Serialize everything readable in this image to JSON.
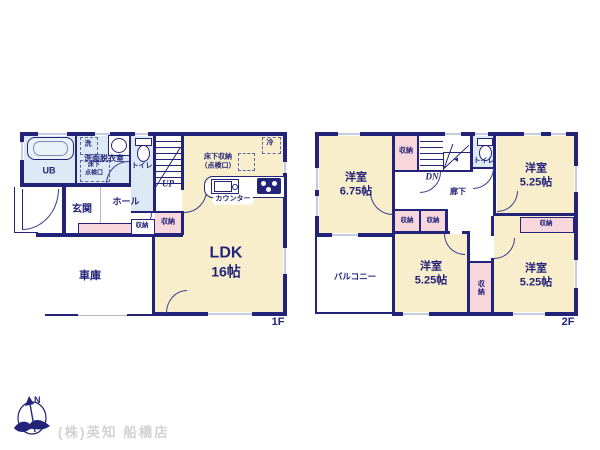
{
  "colors": {
    "wall_navy": "#23237a",
    "room_cream": "#f8eecb",
    "closet_pink": "#f8d7dc",
    "wet_area_blue": "#dde9f4",
    "company_gray": "#d3d3d3"
  },
  "floor1": {
    "label": "1F",
    "ub": "UB",
    "washer": "洗",
    "washroom": "洗面脱衣室",
    "inspect1": "床下",
    "inspect2": "点検口",
    "toilet": "トイレ",
    "up": "UP",
    "underfloor1": "床下収納",
    "underfloor2": "（点検口）",
    "fridge": "冷",
    "counter": "カウンター",
    "entrance": "玄関",
    "hall": "ホール",
    "closet_hall": "収納",
    "closet_ldk": "収納",
    "ldk": "LDK",
    "ldk_size": "16帖",
    "garage": "車庫"
  },
  "floor2": {
    "label": "2F",
    "room_nw": "洋室",
    "room_nw_size": "6.75帖",
    "closet_nw": "収納",
    "dn": "DN",
    "toilet": "トイレ",
    "hallway": "廊下",
    "room_ne": "洋室",
    "room_ne_size": "5.25帖",
    "closet_a": "収納",
    "closet_b": "収納",
    "room_c": "洋室",
    "room_c_size": "5.25帖",
    "closet_mid": "収納",
    "room_se": "洋室",
    "room_se_size": "5.25帖",
    "closet_se": "収納",
    "balcony": "バルコニー"
  },
  "footer": {
    "north": "N",
    "company": "(株)英知 船橋店"
  }
}
